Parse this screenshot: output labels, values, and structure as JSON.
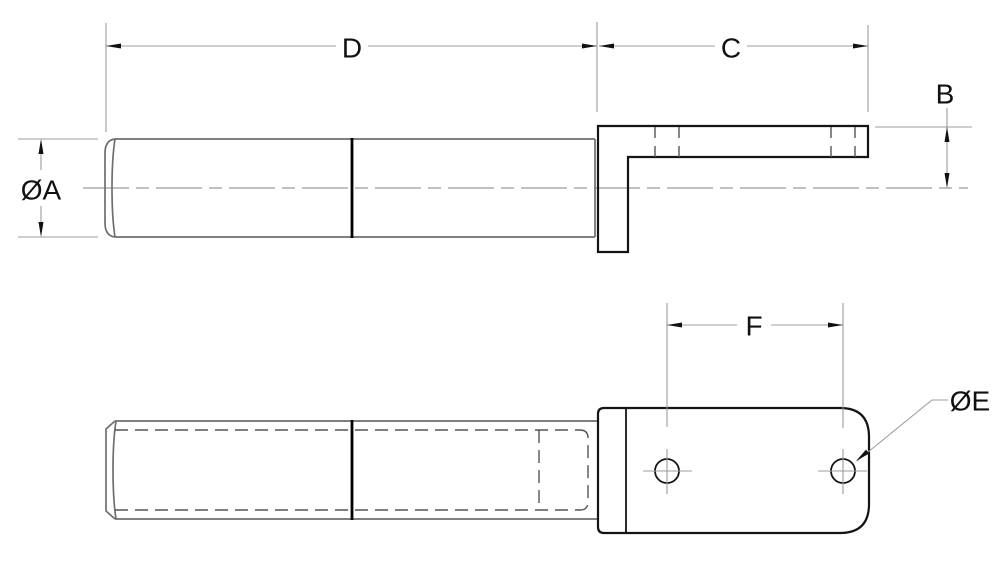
{
  "labels": {
    "diameter_a": "ØA",
    "length_d": "D",
    "length_c": "C",
    "height_b": "B",
    "hole_spacing_f": "F",
    "hole_diameter_e": "ØE"
  },
  "colors": {
    "background": "#ffffff",
    "object_line": "#6f6f6f",
    "bracket_line": "#141414",
    "seam_line": "#000000",
    "dimension_line": "#9c9c9c",
    "hidden_line": "#555555",
    "text": "#111111"
  }
}
